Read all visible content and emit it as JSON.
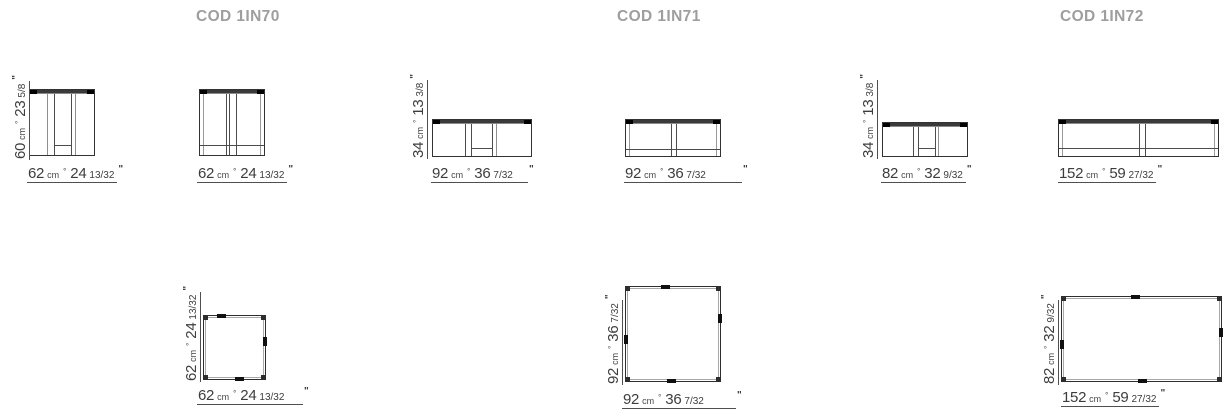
{
  "colors": {
    "background": "#ffffff",
    "header_text": "#9e9e9e",
    "line": "#333333",
    "inner_line": "#8f8f8f",
    "dimension_text": "#3d3d3d"
  },
  "columns": [
    {
      "code": "COD 1IN70",
      "front_a": {
        "height": {
          "cm": "60",
          "unit": "cm",
          "sep": "°",
          "in": "23",
          "frac": "5/8",
          "mark": "\""
        },
        "width": {
          "cm": "62",
          "unit": "cm",
          "sep": "°",
          "in": "24",
          "frac": "13/32",
          "mark": "\""
        }
      },
      "front_b": {
        "width": {
          "cm": "62",
          "unit": "cm",
          "sep": "°",
          "in": "24",
          "frac": "13/32",
          "mark": "\""
        }
      },
      "plan": {
        "height": {
          "cm": "62",
          "unit": "cm",
          "sep": "°",
          "in": "24",
          "frac": "13/32",
          "mark": "\""
        },
        "width": {
          "cm": "62",
          "unit": "cm",
          "sep": "°",
          "in": "24",
          "frac": "13/32",
          "mark": "\""
        }
      }
    },
    {
      "code": "COD 1IN71",
      "front_a": {
        "height": {
          "cm": "34",
          "unit": "cm",
          "sep": "°",
          "in": "13",
          "frac": "3/8",
          "mark": "\""
        },
        "width": {
          "cm": "92",
          "unit": "cm",
          "sep": "°",
          "in": "36",
          "frac": "7/32",
          "mark": "\""
        }
      },
      "front_b": {
        "width": {
          "cm": "92",
          "unit": "cm",
          "sep": "°",
          "in": "36",
          "frac": "7/32",
          "mark": "\""
        }
      },
      "plan": {
        "height": {
          "cm": "92",
          "unit": "cm",
          "sep": "°",
          "in": "36",
          "frac": "7/32",
          "mark": "\""
        },
        "width": {
          "cm": "92",
          "unit": "cm",
          "sep": "°",
          "in": "36",
          "frac": "7/32",
          "mark": "\""
        }
      }
    },
    {
      "code": "COD 1IN72",
      "front_a": {
        "height": {
          "cm": "34",
          "unit": "cm",
          "sep": "°",
          "in": "13",
          "frac": "3/8",
          "mark": "\""
        },
        "width": {
          "cm": "82",
          "unit": "cm",
          "sep": "°",
          "in": "32",
          "frac": "9/32",
          "mark": "\""
        }
      },
      "front_b": {
        "width": {
          "cm": "152",
          "unit": "cm",
          "sep": "°",
          "in": "59",
          "frac": "27/32",
          "mark": "\""
        }
      },
      "plan": {
        "height": {
          "cm": "82",
          "unit": "cm",
          "sep": "°",
          "in": "32",
          "frac": "9/32",
          "mark": "\""
        },
        "width": {
          "cm": "152",
          "unit": "cm",
          "sep": "°",
          "in": "59",
          "frac": "27/32",
          "mark": "\""
        }
      }
    }
  ]
}
